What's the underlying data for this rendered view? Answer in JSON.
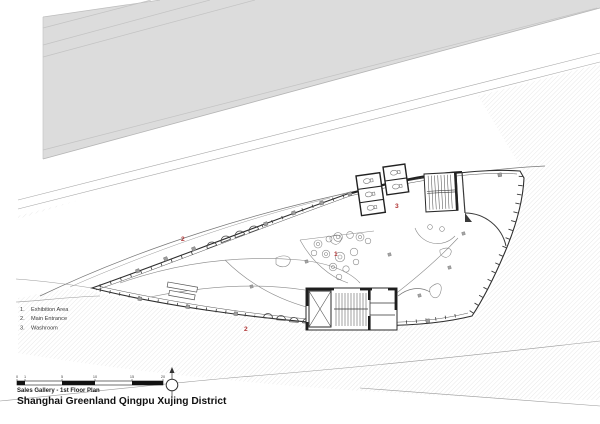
{
  "sheet": {
    "legend": {
      "items": [
        {
          "num": "1.",
          "label": "Exhibition Area"
        },
        {
          "num": "2.",
          "label": "Main Entrance"
        },
        {
          "num": "3.",
          "label": "Washroom"
        }
      ]
    },
    "plan_labels": {
      "entrance_north": "2",
      "exhibition": "1",
      "washroom": "3",
      "entrance_south": "2"
    },
    "scale_bar": {
      "ticks": [
        "0",
        "1",
        "5",
        "10",
        "15",
        "20"
      ]
    },
    "title_block": {
      "phase": "Sales Gallery - 1st Floor Plan",
      "project": "Shanghai Greenland Qingpu Xujing District"
    },
    "colors": {
      "paper": "#ffffff",
      "road_gray": "#dcdcdc",
      "hatch_line": "#d6d6d6",
      "ink": "#2e2e2e",
      "light_line": "#8a8a8a",
      "accent_red": "#b03434"
    }
  }
}
